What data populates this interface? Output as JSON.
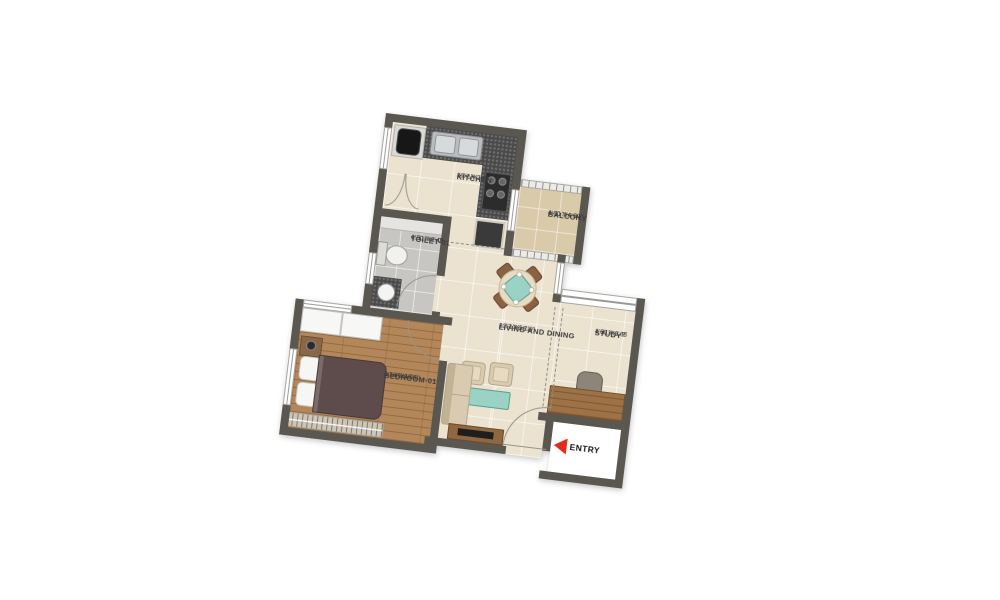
{
  "title": "1BHK apartment floor plan",
  "rooms": {
    "kitchen": {
      "name": "KITCHEN",
      "imperial": "10'-1\"X7'-1\"",
      "metric": "3.07 X 2.15"
    },
    "balcony": {
      "name": "BALCONY",
      "imperial": "4'-11\"X4'-11\"",
      "metric": "1.50 X 1.50"
    },
    "toilet": {
      "name": "TOILET-01",
      "imperial": "4'-11\"X8'-0\"",
      "metric": "1.50 X 2.45"
    },
    "bedroom": {
      "name": "BEDROOM-01",
      "imperial": "10'-4\"X10'-0\"",
      "metric": "3.16 X 3.05"
    },
    "living": {
      "name": "LIVING AND DINING",
      "imperial": "10'-1\"X16'-9\"",
      "metric": "3.07 X 5.11"
    },
    "study": {
      "name": "STUDY",
      "imperial": "4'-11\"X6'-9\"",
      "metric": "1.50 X 2.05"
    }
  },
  "entry": {
    "label": "ENTRY"
  },
  "colors": {
    "entry_arrow": "#e02b20",
    "wall": "#5a5750",
    "floor_tile": "#ebe2cf",
    "bedroom_wood": "#b3875a",
    "accent_teal": "#9ad2c6",
    "duvet": "#5e4c4c"
  }
}
